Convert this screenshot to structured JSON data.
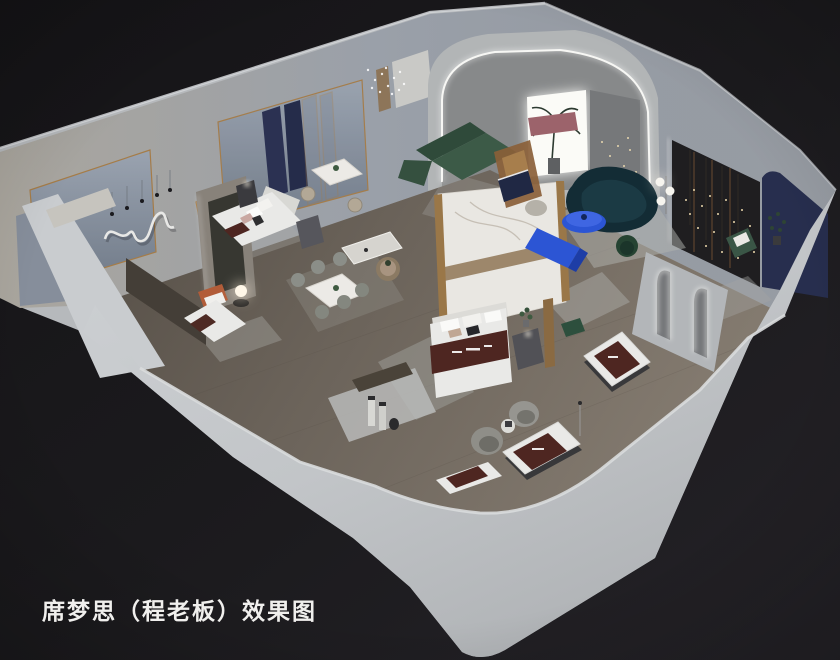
{
  "scene": {
    "type": "3d-interior-render",
    "style": "isometric-cutaway",
    "subject": "Simmons mattress showroom floor-plan rendering",
    "caption": "席梦思（程老板）效果图"
  },
  "palette": {
    "background": "#1b1a1d",
    "outer_wall": "#c3c6c9",
    "wall_top": "#d8dadc",
    "inner_wall": "#9aa0a9",
    "floor": "#6b635a",
    "rug": "#b2b4b0",
    "marble": "#e9e7e2",
    "brass": "#a57c48",
    "navy_panel": "#2b3152",
    "navy_wall": "#272e4e",
    "charcoal_wall": "#1f1e20",
    "slate_window": "#8e98a6",
    "mattress": "#e9e9e7",
    "burgundy": "#4e2621",
    "cobalt": "#2c55d4",
    "teal": "#132c35",
    "green": "#3c5a47",
    "blush": "#9c636b",
    "terracotta": "#b25c38",
    "led": "#f7f7f4",
    "caption_text": "#f0efed"
  },
  "elements": [
    "outer-walls",
    "showroom-floor",
    "arch-feature-wall",
    "led-arch",
    "glowing-window",
    "charcoal-feature-wall",
    "navy-accent-wall",
    "marble-partition",
    "green-corner-sofa",
    "teal-curved-sofa",
    "cobalt-coffee-table",
    "cobalt-media-console",
    "pink-daybed",
    "bed-display-main",
    "bed-display-left",
    "bed-display-single",
    "mattress-display-1",
    "mattress-display-2",
    "mattress-display-3",
    "swivel-armchairs",
    "dining-table-six",
    "dining-table-two",
    "round-side-table",
    "arched-mirror-partition",
    "wall-squiggle-art",
    "crystal-pendant",
    "orb-lamp",
    "floor-lamp-globes",
    "caption"
  ]
}
